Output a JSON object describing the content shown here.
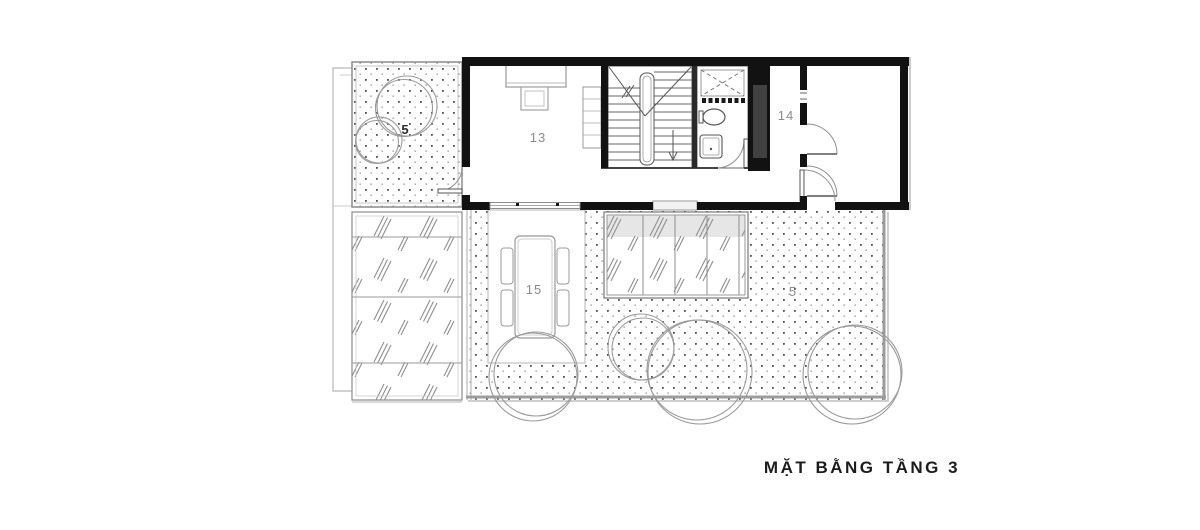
{
  "title": "MẶT BẰNG TẦNG 3",
  "labels": {
    "terrace_upper": "5",
    "room_13": "13",
    "room_14": "14",
    "room_15": "15",
    "terrace_lower": "5"
  },
  "colors": {
    "wall": "#121212",
    "line_dark": "#555555",
    "line_light": "#9a9a9a",
    "label_gray": "#8a8a8a",
    "glass_band": "#e6e6e6",
    "background": "#ffffff"
  }
}
